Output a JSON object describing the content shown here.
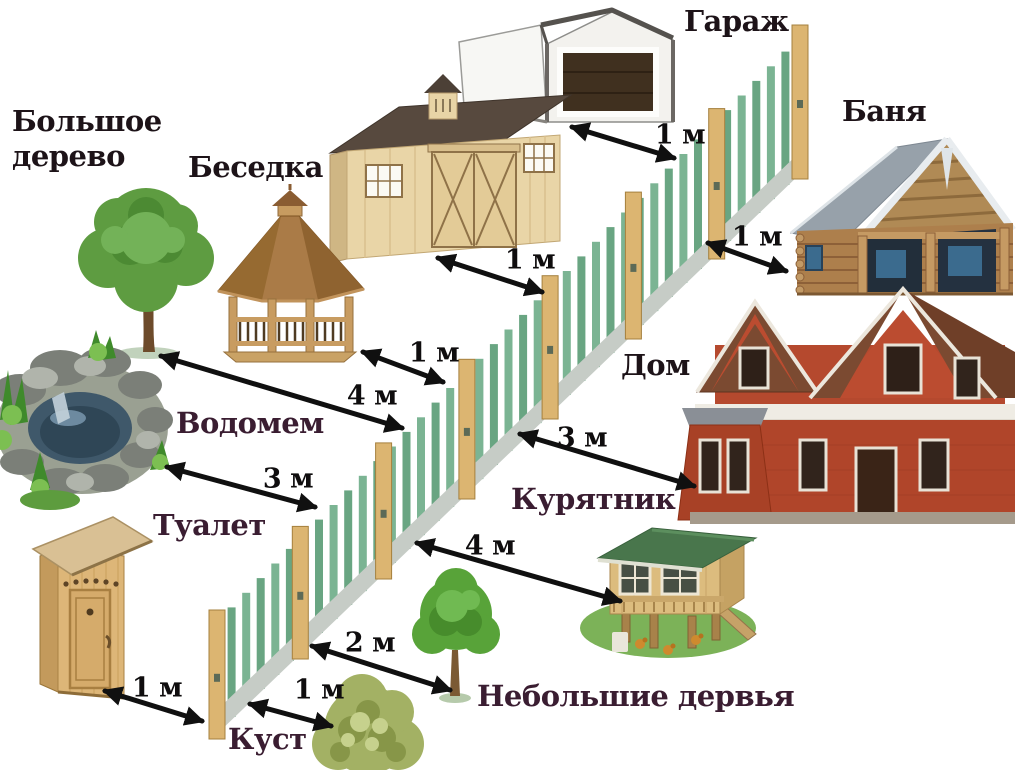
{
  "diagram": {
    "type": "infographic",
    "language": "ru",
    "subject": "setback distances from fence to buildings and plantings",
    "background": "#ffffff",
    "colors": {
      "label_dark": "#1d1318",
      "label_plum": "#3a1d31",
      "distance_text": "#0f0d0e",
      "arrow": "#101010",
      "fence_picket": "#7bb493",
      "fence_picket_alt": "#69a582",
      "fence_post": "#dcb571",
      "fence_rail": "#c6ccc6"
    },
    "objects": {
      "big_tree": {
        "label": "Большое дерево"
      },
      "gazebo": {
        "label": "Беседка"
      },
      "garage": {
        "label": "Гараж"
      },
      "banya": {
        "label": "Баня"
      },
      "house": {
        "label": "Дом"
      },
      "pond": {
        "label": "Водомем"
      },
      "toilet": {
        "label": "Туалет"
      },
      "chicken_coop": {
        "label": "Курятник"
      },
      "small_trees": {
        "label": "Небольшие дервья"
      },
      "bush": {
        "label": "Куст"
      }
    },
    "distances": [
      {
        "id": "garage-fence",
        "object": "Гараж",
        "label": "1 м"
      },
      {
        "id": "shed-fence",
        "object": "сарай",
        "label": "1 м"
      },
      {
        "id": "gazebo-fence",
        "object": "Беседка",
        "label": "1 м"
      },
      {
        "id": "banya-fence",
        "object": "Баня",
        "label": "1 м"
      },
      {
        "id": "big-tree-fence",
        "object": "Большое дерево",
        "label": "4 м"
      },
      {
        "id": "pond-fence",
        "object": "Водомем",
        "label": "3 м"
      },
      {
        "id": "house-fence",
        "object": "Дом",
        "label": "3 м"
      },
      {
        "id": "coop-fence",
        "object": "Курятник",
        "label": "4 м"
      },
      {
        "id": "small-trees-fence",
        "object": "Небольшие дервья",
        "label": "2 м"
      },
      {
        "id": "bush-fence",
        "object": "Куст",
        "label": "1 м"
      },
      {
        "id": "toilet-fence",
        "object": "Туалет",
        "label": "1 м"
      }
    ]
  }
}
